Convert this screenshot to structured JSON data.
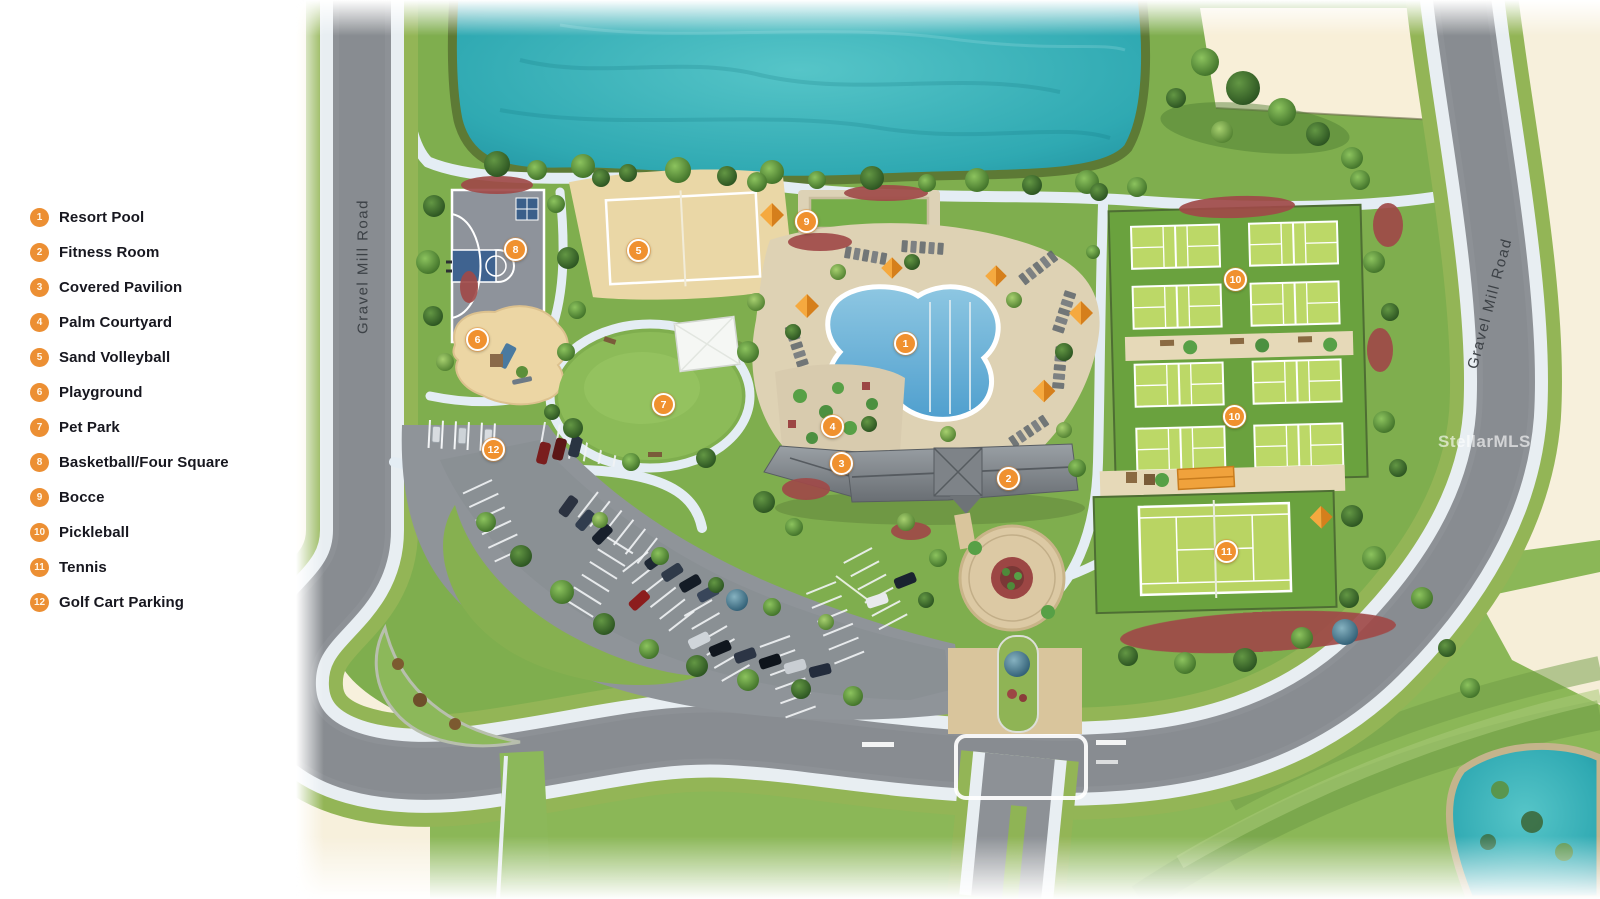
{
  "page": {
    "background": "#ffffff",
    "canvas_cream": "#f7f0dc"
  },
  "legend": {
    "circle_color": "#ec8f33",
    "text_color": "#17171f",
    "items": [
      {
        "number": "1",
        "label": "Resort Pool"
      },
      {
        "number": "2",
        "label": "Fitness Room"
      },
      {
        "number": "3",
        "label": "Covered Pavilion"
      },
      {
        "number": "4",
        "label": "Palm Courtyard"
      },
      {
        "number": "5",
        "label": "Sand Volleyball"
      },
      {
        "number": "6",
        "label": "Playground"
      },
      {
        "number": "7",
        "label": "Pet Park"
      },
      {
        "number": "8",
        "label": "Basketball/Four Square"
      },
      {
        "number": "9",
        "label": "Bocce"
      },
      {
        "number": "10",
        "label": "Pickleball"
      },
      {
        "number": "11",
        "label": "Tennis"
      },
      {
        "number": "12",
        "label": "Golf Cart Parking"
      }
    ]
  },
  "map": {
    "road_labels": [
      {
        "text": "Gravel Mill Road",
        "orientation": "vertical-left"
      },
      {
        "text": "Gravel Mill Road",
        "orientation": "diagonal-right"
      }
    ],
    "watermark": {
      "text": "StellarMLS"
    },
    "marker_style": {
      "fill": "#f0912f",
      "ring": "#ffffff",
      "text": "#ffffff"
    },
    "colors": {
      "lake_teal": "#2fb0ba",
      "pool_blue": "#5ba8d4",
      "grass_green": "#7fae4e",
      "court_green": "#bcd867",
      "road_gray": "#8d9196",
      "sand_tan": "#ead7a6",
      "mulch_red": "#a04a48",
      "deck_stone": "#ded2b4"
    },
    "markers": [
      {
        "number": "1",
        "x": 905,
        "y": 343
      },
      {
        "number": "2",
        "x": 1008,
        "y": 478
      },
      {
        "number": "3",
        "x": 841,
        "y": 463
      },
      {
        "number": "4",
        "x": 832,
        "y": 426
      },
      {
        "number": "5",
        "x": 638,
        "y": 250
      },
      {
        "number": "6",
        "x": 477,
        "y": 339
      },
      {
        "number": "7",
        "x": 663,
        "y": 404
      },
      {
        "number": "8",
        "x": 515,
        "y": 249
      },
      {
        "number": "9",
        "x": 806,
        "y": 221
      },
      {
        "number": "10",
        "x": 1235,
        "y": 279
      },
      {
        "number": "10",
        "x": 1234,
        "y": 416
      },
      {
        "number": "11",
        "x": 1226,
        "y": 551
      },
      {
        "number": "12",
        "x": 493,
        "y": 449
      }
    ]
  }
}
